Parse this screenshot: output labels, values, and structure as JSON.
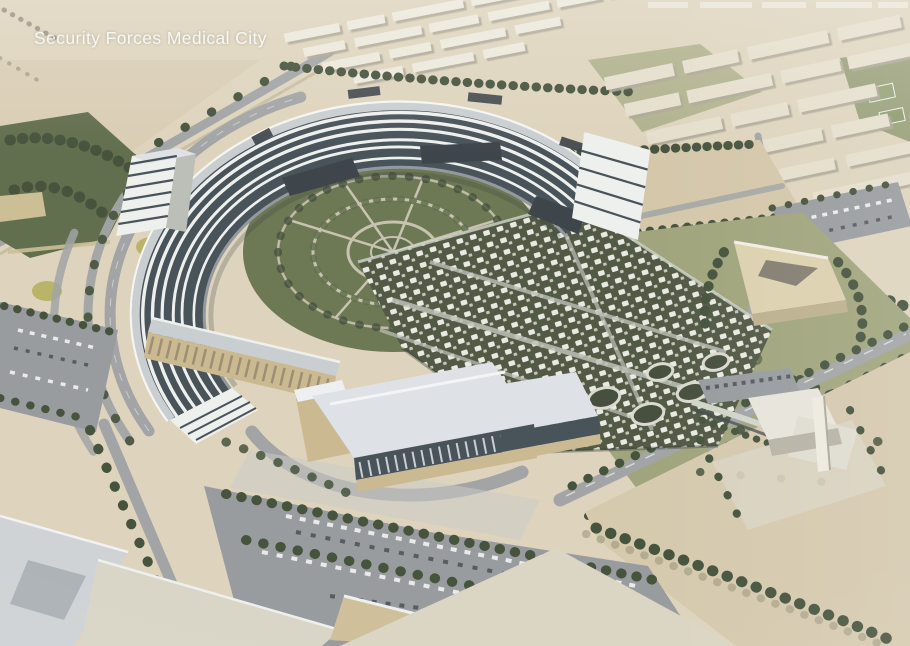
{
  "caption": {
    "title": "Security Forces Medical City"
  },
  "scene": {
    "type": "aerial-architectural-rendering",
    "subject": "hospital campus in a desert city",
    "landmarks": [
      "crescent-shaped hospital building with banded glass floors",
      "circular courtyard gardens inside the crescent",
      "green-roof clinic podium with grid of white skylight pavilions",
      "main entrance buildings with colonnades and stone bases",
      "conference building east of the campus",
      "mosque at the south-east corner",
      "tree-lined surface parking lots",
      "residential apartment blocks to the north and east",
      "desert terrain with access roads"
    ]
  },
  "colors": {
    "sand": "#d3c7aa",
    "sandlight": "#ddd2ba",
    "sanddark": "#c6b897",
    "road": "#9da0a1",
    "asphalt": "#94979a",
    "treedark": "#3d4a33",
    "treemid": "#5a6845",
    "lawn": "#9ba177",
    "lawndark": "#7e8a5c",
    "white": "#eceae0",
    "bshadow": "#a9a291",
    "glass": "#404a52",
    "floor": "#eef0ee",
    "roof": "#c7cccf",
    "rooflight": "#dde0e4",
    "stone": "#c9b68c",
    "greenroof": "#49523d",
    "pavilion": "#e8e8e0",
    "court": "#66714b",
    "path": "#c6c0ac",
    "caption": "#ffffff"
  }
}
